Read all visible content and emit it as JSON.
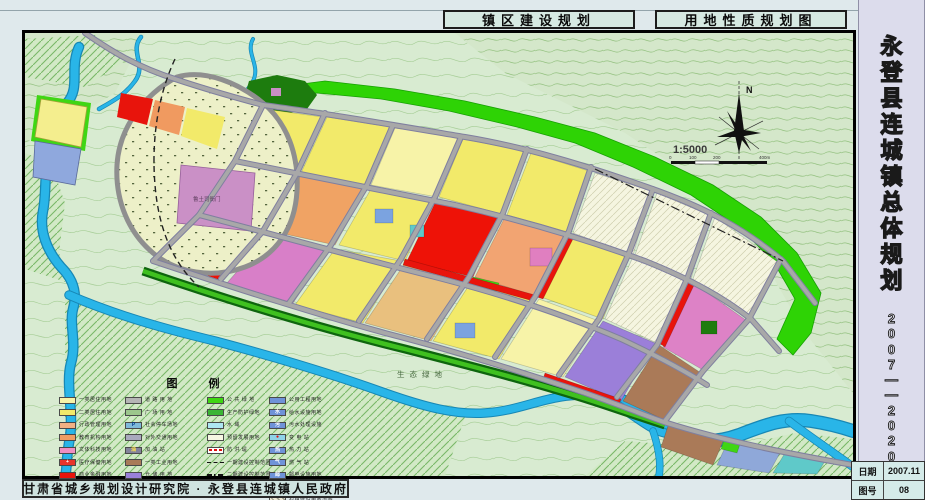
{
  "header": {
    "tabs": [
      {
        "label": "镇区建设规划"
      },
      {
        "label": "用地性质规划图"
      }
    ]
  },
  "sidebar": {
    "title": "永登县连城镇总体规划",
    "years": "2007——2020",
    "info": [
      {
        "label": "日期",
        "value": "2007.11"
      },
      {
        "label": "图号",
        "value": "08"
      }
    ]
  },
  "footer": {
    "credit": "甘肃省城乡规划设计研究院 · 永登县连城镇人民政府"
  },
  "map": {
    "north_label": "N",
    "scale_text": "1:5000",
    "scale_ticks": [
      "0",
      "100",
      "200",
      "400m"
    ],
    "labels": {
      "eco_green": "生态绿地",
      "heritage_site": "鲁土司衙门"
    },
    "colors": {
      "topo_bg": "#d8ebd1",
      "river": "#29b5e8",
      "public_green": "#2ed305",
      "road": "#a8a8a8",
      "residential": "#f2ea6a",
      "commercial_red": "#e8140c",
      "culture_pink": "#d87fc8",
      "industry_brown": "#a87a58",
      "warehouse_purple": "#9a80da",
      "utility_blue": "#6f93d8"
    }
  },
  "legend": {
    "title": "图  例",
    "columns": [
      [
        {
          "label": "一类居住用地",
          "bg": "#f7f3a8"
        },
        {
          "label": "二类居住用地",
          "bg": "#f2ea6a"
        },
        {
          "label": "行政管理用地",
          "bg": "#f2b084"
        },
        {
          "label": "教育机构用地",
          "bg": "#ef9c62"
        },
        {
          "label": "文体科技用地",
          "bg": "#ef8fc2"
        },
        {
          "label": "医疗保健用地",
          "bg": "#e8342a",
          "glyph": "+",
          "glyph_color": "#ffffff"
        },
        {
          "label": "商业金融用地",
          "bg": "#e8140c"
        },
        {
          "label": "集贸设施用地",
          "bg": "#d5120c",
          "glyph": "★",
          "glyph_color": "#ffffff"
        }
      ],
      [
        {
          "label": "道 路 用 地",
          "bg": "#b5b5b5"
        },
        {
          "label": "广 场 用 地",
          "bg": "#9cc68c"
        },
        {
          "label": "社会停车场地",
          "bg": "#7fb9da",
          "glyph": "P",
          "glyph_color": "#003a8c"
        },
        {
          "label": "对外交通用地",
          "bg": "#a9a9bd"
        },
        {
          "label": "加 油 站",
          "bg": "#83839a",
          "glyph": "油",
          "glyph_color": "#ffe14d"
        },
        {
          "label": "一类工业用地",
          "bg": "#a87a58"
        },
        {
          "label": "仓 储 用 地",
          "bg": "#9a80da"
        },
        {
          "label": "堆 场 用 地",
          "bg": "#e2bc7d"
        }
      ],
      [
        {
          "label": "公 共 绿 地",
          "bg": "#3fd613"
        },
        {
          "label": "生产防护绿地",
          "bg": "#3ab535"
        },
        {
          "label": "水  域",
          "bg": "#aee6f2"
        },
        {
          "label": "预留发展用地",
          "bg": "#f6f6e2"
        },
        {
          "label": "防 洪 堤",
          "kind": "dash-red"
        },
        {
          "label": "一期建设控制范围",
          "kind": "dash-black"
        },
        {
          "label": "二期建设控制范围",
          "kind": "dashdot-black"
        },
        {
          "label": "堤岸防护用地",
          "bg": "#8fa8cf"
        }
      ],
      [
        {
          "label": "公用工程用地",
          "bg": "#6f93d8"
        },
        {
          "label": "给水设施用地",
          "bg": "#6f93d8",
          "glyph": "水",
          "glyph_color": "#ffffff"
        },
        {
          "label": "污水处理设施",
          "bg": "#6f93d8",
          "glyph": "污",
          "glyph_color": "#ffffff"
        },
        {
          "label": "变 电 站",
          "bg": "#8fd2e8",
          "glyph": "●",
          "glyph_color": "#e01010"
        },
        {
          "label": "热 力 站",
          "bg": "#6f93d8",
          "glyph": "热",
          "glyph_color": "#ffffff"
        },
        {
          "label": "燃 气 站",
          "bg": "#6f93d8",
          "glyph": "气",
          "glyph_color": "#ffffff"
        },
        {
          "label": "邮电设施用地",
          "bg": "#6f93d8",
          "glyph": "邮",
          "glyph_color": "#ffffff"
        },
        {
          "label": "环卫设施用地",
          "bg": "#6f93d8",
          "glyph": "卫",
          "glyph_color": "#ffffff"
        },
        {
          "label": "村镇建设用地范围",
          "kind": "hatch"
        }
      ]
    ]
  }
}
